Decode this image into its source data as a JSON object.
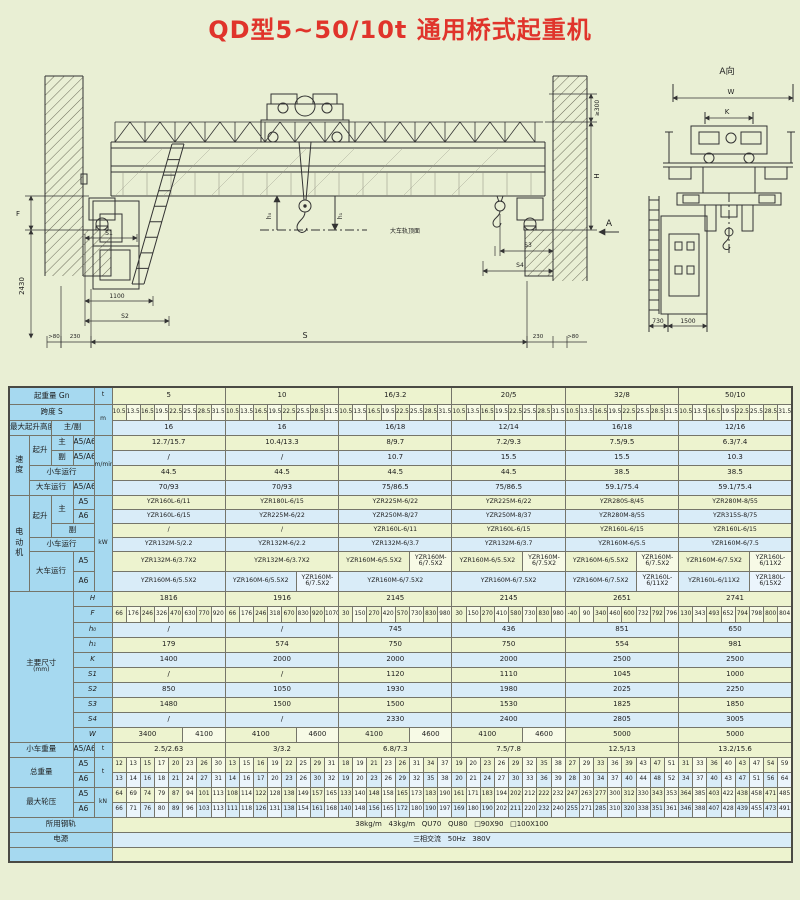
{
  "title": "QD型5~50/10t 通用桥式起重机",
  "drawing": {
    "view_label": "A向",
    "rail_top_label": "大车轨顶面",
    "dims": {
      "F": "F",
      "v2430": "2430",
      "S1": "S1",
      "d1100": "1100",
      "S2": "S2",
      "gt80L": ">80",
      "d230L": "230",
      "S": "S",
      "d230R": "230",
      "gt80R": ">80",
      "ge300": "≥300",
      "H": "H",
      "S3": "S3",
      "S4": "S4",
      "A": "A",
      "h0": "h₀",
      "h1": "h₁",
      "W": "W",
      "K": "K",
      "d730": "730",
      "d1500": "1500"
    }
  },
  "table": {
    "labels": {
      "capacity": "起重量 Gn",
      "span": "跨度 S",
      "lift_height": "最大起升高度",
      "main_aux": "主/副",
      "speed": "速度",
      "hoist": "起升",
      "main": "主",
      "aux": "副",
      "a5a6": "A5/A6",
      "a5": "A5",
      "a6": "A6",
      "trolley_travel": "小车运行",
      "bridge_travel": "大车运行",
      "motor": "电动机",
      "main_dims": "主要尺寸",
      "mm": "(mm)",
      "trolley_weight": "小车重量",
      "total_weight": "总重量",
      "max_wheel_load": "最大轮压",
      "rail": "所用钢轨",
      "power": "电源",
      "dim_keys": [
        "H",
        "F",
        "h₀",
        "h₁",
        "K",
        "S1",
        "S2",
        "S3",
        "S4",
        "W"
      ]
    },
    "units": {
      "t": "t",
      "m": "m",
      "m_min": "m/min",
      "kw": "kW",
      "kn": "kN"
    },
    "capacities": [
      "5",
      "10",
      "16/3.2",
      "20/5",
      "32/8",
      "50/10"
    ],
    "span_values": [
      "10.5",
      "13.5",
      "16.5",
      "19.5",
      "22.5",
      "25.5",
      "28.5",
      "31.5"
    ],
    "lift_heights": [
      "16",
      "16",
      "16/18",
      "12/14",
      "16/18",
      "12/16"
    ],
    "speeds": {
      "hoist_main": [
        "12.7/15.7",
        "10.4/13.3",
        "8/9.7",
        "7.2/9.3",
        "7.5/9.5",
        "6.3/7.4"
      ],
      "hoist_aux": [
        "/",
        "/",
        "10.7",
        "15.5",
        "15.5",
        "10.3"
      ],
      "trolley": [
        "44.5",
        "44.5",
        "44.5",
        "44.5",
        "38.5",
        "38.5"
      ],
      "bridge": [
        "70/93",
        "70/93",
        "75/86.5",
        "75/86.5",
        "59.1/75.4",
        "59.1/75.4"
      ]
    },
    "motors": {
      "hoist_main_a5": [
        "YZR160L-6/11",
        "YZR180L-6/15",
        "YZR225M-6/22",
        "YZR225M-6/22",
        "YZR280S-8/45",
        "YZR280M-8/55"
      ],
      "hoist_main_a6": [
        "YZR160L-6/15",
        "YZR225M-6/22",
        "YZR250M-8/27",
        "YZR250M-8/37",
        "YZR280M-8/55",
        "YZR315S-8/75"
      ],
      "hoist_aux": [
        "/",
        "/",
        "YZR160L-6/11",
        "YZR160L-6/15",
        "YZR160L-6/15",
        "YZR160L-6/15"
      ],
      "trolley": [
        "YZR132M-5/2.2",
        "YZR132M-6/2.2",
        "YZR132M-6/3.7",
        "YZR132M-6/3.7",
        "YZR160M-6/5.5",
        "YZR160M-6/7.5"
      ],
      "bridge_a5": [
        [
          "YZR132M-6/3.7X2"
        ],
        [
          "YZR132M-6/3.7X2"
        ],
        [
          "YZR160M-6/5.5X2",
          "YZR160M-6/7.5X2"
        ],
        [
          "YZR160M-6/5.5X2",
          "YZR160M-6/7.5X2"
        ],
        [
          "YZR160M-6/5.5X2",
          "YZR160M-6/7.5X2"
        ],
        [
          "YZR160M-6/7.5X2",
          "YZR160L-6/11X2"
        ]
      ],
      "bridge_a6": [
        [
          "YZR160M-6/5.5X2"
        ],
        [
          "YZR160M-6/5.5X2",
          "YZR160M-6/7.5X2"
        ],
        [
          "YZR160M-6/7.5X2"
        ],
        [
          "YZR160M-6/7.5X2"
        ],
        [
          "YZR160M-6/7.5X2",
          "YZR160L-6/11X2"
        ],
        [
          "YZR160L-6/11X2",
          "YZR180L-6/15X2"
        ]
      ]
    },
    "dims": {
      "H": [
        "1816",
        "1916",
        "2145",
        "2145",
        "2651",
        "2741"
      ],
      "F": [
        [
          "66",
          "176",
          "246",
          "326",
          "470",
          "630",
          "770",
          "920"
        ],
        [
          "66",
          "176",
          "246",
          "318",
          "670",
          "830",
          "920",
          "1070"
        ],
        [
          "30",
          "150",
          "270",
          "420",
          "570",
          "730",
          "830",
          "980"
        ],
        [
          "30",
          "150",
          "270",
          "410",
          "580",
          "730",
          "830",
          "980"
        ],
        [
          "-40",
          "90",
          "340",
          "460",
          "600",
          "732",
          "792",
          "796"
        ],
        [
          "130",
          "343",
          "493",
          "652",
          "794",
          "798",
          "800",
          "804"
        ]
      ],
      "h0": [
        "/",
        "/",
        "745",
        "436",
        "851",
        "650"
      ],
      "h1": [
        "179",
        "574",
        "750",
        "750",
        "554",
        "981"
      ],
      "K": [
        "1400",
        "2000",
        "2000",
        "2000",
        "2500",
        "2500"
      ],
      "S1": [
        "/",
        "/",
        "1120",
        "1110",
        "1045",
        "1000"
      ],
      "S2": [
        "850",
        "1050",
        "1930",
        "1980",
        "2025",
        "2250"
      ],
      "S3": [
        "1480",
        "1500",
        "1500",
        "1530",
        "1825",
        "1850"
      ],
      "S4": [
        "/",
        "/",
        "2330",
        "2400",
        "2805",
        "3005"
      ],
      "W": [
        [
          "3400",
          "4100"
        ],
        [
          "4100",
          "4600"
        ],
        [
          "4100",
          "4600"
        ],
        [
          "4100",
          "4600"
        ],
        [
          "5000"
        ],
        [
          "5000"
        ]
      ]
    },
    "trolley_weights": [
      "2.5/2.63",
      "3/3.2",
      "6.8/7.3",
      "7.5/7.8",
      "12.5/13",
      "13.2/15.6"
    ],
    "total_weight_a5": [
      [
        "12",
        "13",
        "15",
        "17",
        "20",
        "23",
        "26",
        "30"
      ],
      [
        "13",
        "15",
        "16",
        "19",
        "22",
        "25",
        "29",
        "31"
      ],
      [
        "18",
        "19",
        "21",
        "23",
        "26",
        "31",
        "34",
        "37"
      ],
      [
        "19",
        "20",
        "23",
        "26",
        "29",
        "32",
        "35",
        "38"
      ],
      [
        "27",
        "29",
        "33",
        "36",
        "39",
        "43",
        "47",
        "51"
      ],
      [
        "31",
        "33",
        "36",
        "40",
        "43",
        "47",
        "54",
        "59"
      ]
    ],
    "total_weight_a6": [
      [
        "13",
        "14",
        "16",
        "18",
        "21",
        "24",
        "27",
        "31"
      ],
      [
        "14",
        "16",
        "17",
        "20",
        "23",
        "26",
        "30",
        "32"
      ],
      [
        "19",
        "20",
        "23",
        "26",
        "29",
        "32",
        "35",
        "38"
      ],
      [
        "20",
        "21",
        "24",
        "27",
        "30",
        "33",
        "36",
        "39"
      ],
      [
        "28",
        "30",
        "34",
        "37",
        "40",
        "44",
        "48",
        "52"
      ],
      [
        "34",
        "37",
        "40",
        "43",
        "47",
        "51",
        "56",
        "64"
      ]
    ],
    "wheel_load_a5": [
      [
        "64",
        "69",
        "74",
        "79",
        "87",
        "94",
        "101",
        "113"
      ],
      [
        "108",
        "114",
        "122",
        "128",
        "138",
        "149",
        "157",
        "165"
      ],
      [
        "133",
        "140",
        "148",
        "158",
        "165",
        "173",
        "183",
        "190"
      ],
      [
        "161",
        "171",
        "183",
        "194",
        "202",
        "212",
        "222",
        "232"
      ],
      [
        "247",
        "263",
        "277",
        "300",
        "312",
        "330",
        "343",
        "353"
      ],
      [
        "364",
        "385",
        "403",
        "422",
        "438",
        "458",
        "471",
        "485"
      ]
    ],
    "wheel_load_a6": [
      [
        "66",
        "71",
        "76",
        "80",
        "89",
        "96",
        "103",
        "113"
      ],
      [
        "111",
        "118",
        "126",
        "131",
        "138",
        "154",
        "161",
        "168"
      ],
      [
        "140",
        "148",
        "156",
        "165",
        "172",
        "180",
        "190",
        "197"
      ],
      [
        "169",
        "180",
        "190",
        "202",
        "211",
        "220",
        "232",
        "240"
      ],
      [
        "255",
        "271",
        "285",
        "310",
        "320",
        "338",
        "351",
        "361"
      ],
      [
        "346",
        "388",
        "407",
        "428",
        "439",
        "455",
        "473",
        "491"
      ]
    ],
    "rail_types": "38kg/m   43kg/m   QU70   QU80   □90X90   □100X100",
    "power_supply": "三相交流   50Hz   380V"
  }
}
